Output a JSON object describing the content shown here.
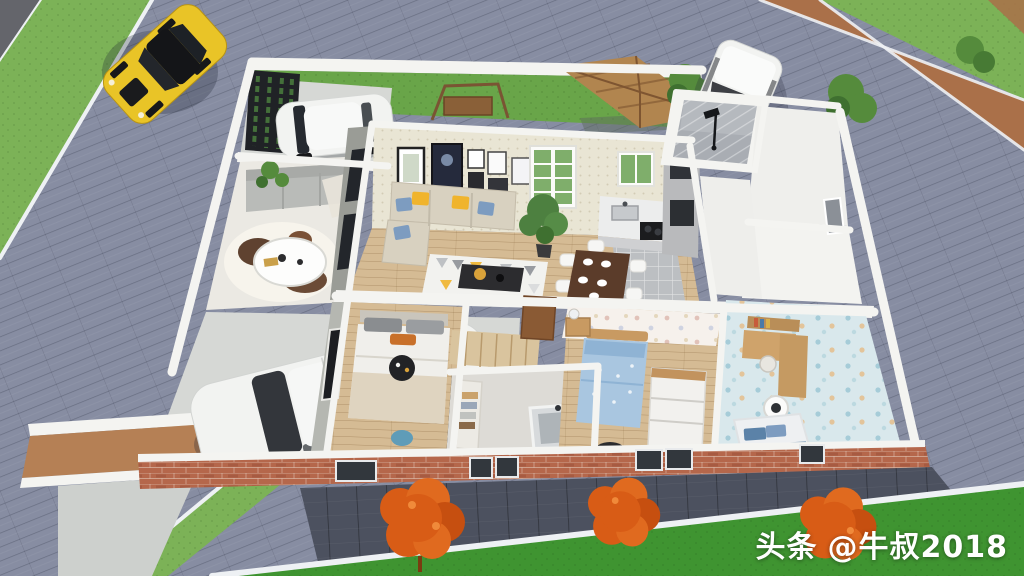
{
  "watermark": {
    "brand": "头条",
    "handle": "@牛叔2018"
  },
  "scene": {
    "type": "3d-floor-plan-render",
    "objects": [
      "yellow-sports-car",
      "white-van",
      "white-hatchback-car",
      "white-sedan-car",
      "house-floor-plan",
      "entrance-gate",
      "backyard-gazebo",
      "swing-bench",
      "patio-lounge",
      "living-room",
      "kitchen",
      "dining-table",
      "shower-room",
      "master-bedroom",
      "kids-bedroom",
      "study-room",
      "bathroom",
      "driveway-ramp",
      "brick-front-wall",
      "orange-shrubs",
      "green-trees",
      "tiled-road",
      "grass-verges"
    ]
  },
  "colors": {
    "road": "#878da2",
    "road_dark": "#64656b",
    "curb": "#eef1f4",
    "grass_top": "#7cb257",
    "grass_yard": "#69a549",
    "grass_bottom": "#3f9431",
    "path_brown": "#aa7049",
    "walkway": "#4c515f",
    "wall": "#f4f4f1",
    "wall_shade": "#d7d7d2",
    "brick": "#b5674b",
    "brick_light": "#cd8766",
    "concrete": "#d6d8d5",
    "patio_floor": "#ebe9e3",
    "wood_floor": "#d5bb94",
    "kitchen_tile": "#bcbfc2",
    "shower_tile": "#a9adb3",
    "wallpaper": "#e9e5d4",
    "polka_pink": "#f6f1ec",
    "polka_blue": "#d9e8ec",
    "sofa_beige": "#d8d1c0",
    "sofa_gray": "#b9bbb8",
    "pillow_blue": "#7d9cc0",
    "pillow_yellow": "#f0b42d",
    "bed_white": "#f0efeb",
    "bed_blue": "#a9c6e0",
    "table_dark": "#2c2c2f",
    "dining_wood": "#5b3c2a",
    "wardrobe_wood": "#d9c49e",
    "door_brown": "#8a5a34",
    "car_yellow": "#e9c427",
    "car_white": "#f2f3f1",
    "car_glass": "#23262b",
    "tree_orange": "#d85c16",
    "tree_green": "#558b3c",
    "gazebo_wood": "#b1854f",
    "watermark": "#ffffff"
  }
}
